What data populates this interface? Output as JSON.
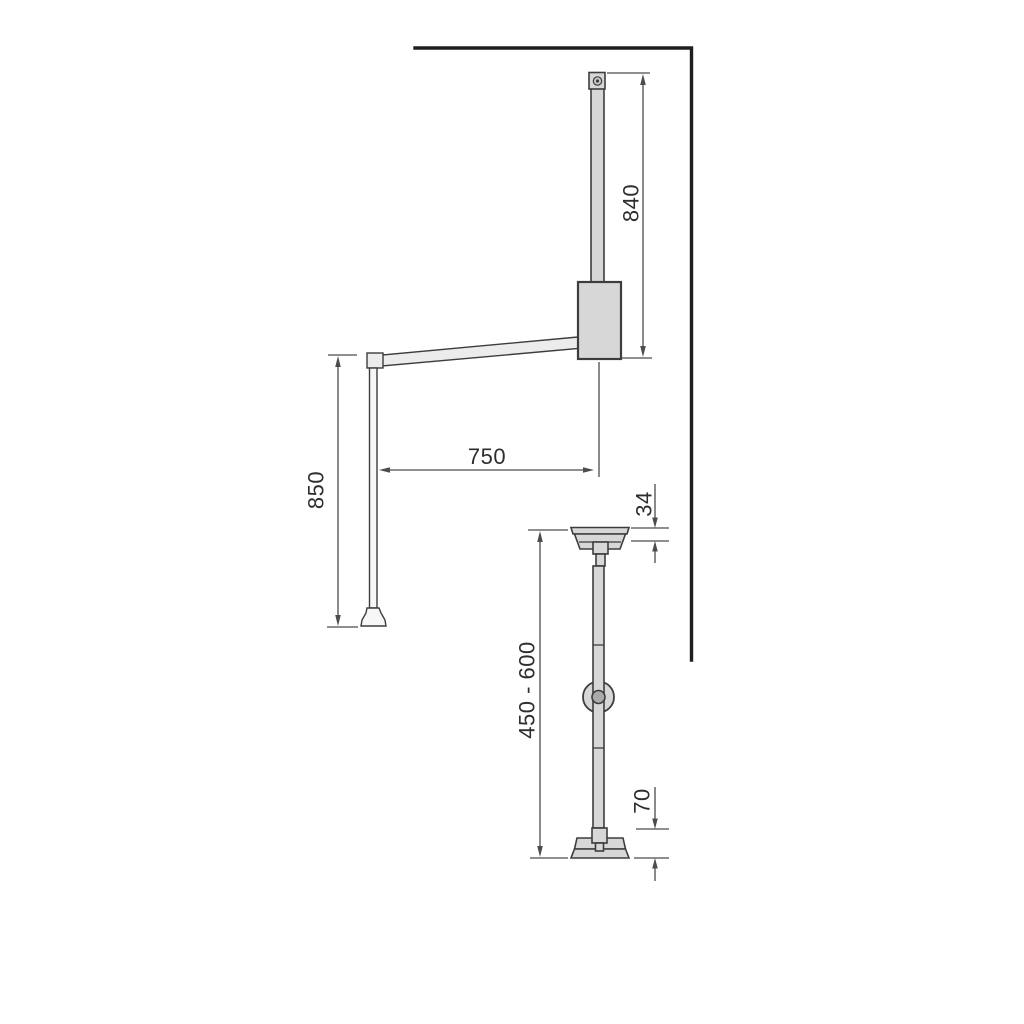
{
  "colors": {
    "background": "#ffffff",
    "wall-line": "#1e1e1e",
    "outline": "#3d3d3d",
    "part-fill": "#d7d7d7",
    "part-fill-light": "#ececec",
    "rod-fill": "#f7f7f7",
    "knob-inner-fill": "#aaaaaa",
    "screw-fill": "#c9c9c9",
    "dim-line": "#4c4c4c",
    "dim-text": "#2e2e2e"
  },
  "figure_top": {
    "dim_rail_height": "840",
    "dim_arm_reach": "750",
    "dim_drop_height": "850"
  },
  "figure_bottom": {
    "dim_bracket_height": "34",
    "dim_adjustable_range": "450 - 600",
    "dim_base_clearance": "70"
  }
}
